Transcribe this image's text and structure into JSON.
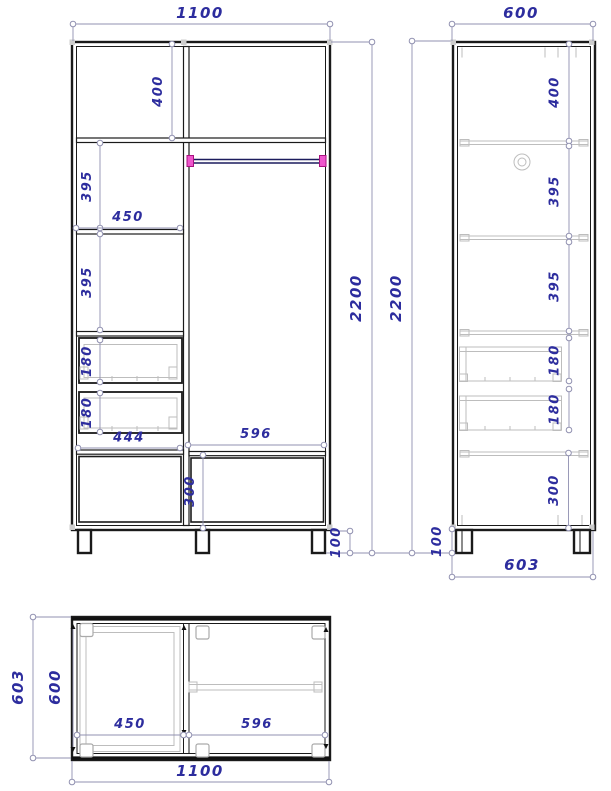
{
  "front_view": {
    "w_total": "1100",
    "h_total_left": "2200",
    "h_total_right": "2200",
    "top_section": "400",
    "shelf_a": "395",
    "shelf_b": "395",
    "left_width": "450",
    "drawer_a": "180",
    "drawer_b": "180",
    "drawer_width": "444",
    "right_width": "596",
    "bottom_section": "300",
    "leg_height": "100"
  },
  "side_view": {
    "depth_top": "600",
    "top_section": "400",
    "shelf_a": "395",
    "shelf_b": "395",
    "drawer_a": "180",
    "drawer_b": "180",
    "bottom_section": "300",
    "leg_height": "100",
    "depth_bottom": "603"
  },
  "plan_view": {
    "depth_outer": "603",
    "depth_inner": "600",
    "left_width": "450",
    "right_width": "596",
    "w_total": "1100"
  },
  "colors": {
    "dim_text": "#2d2d9e",
    "dim_line": "#9090b0",
    "outline": "#1a1a1a",
    "detail_gray": "#bdbdbd",
    "rod_navy": "#1c1c5e",
    "rod_cap_pink": "#ee55cc",
    "background": "#ffffff"
  }
}
